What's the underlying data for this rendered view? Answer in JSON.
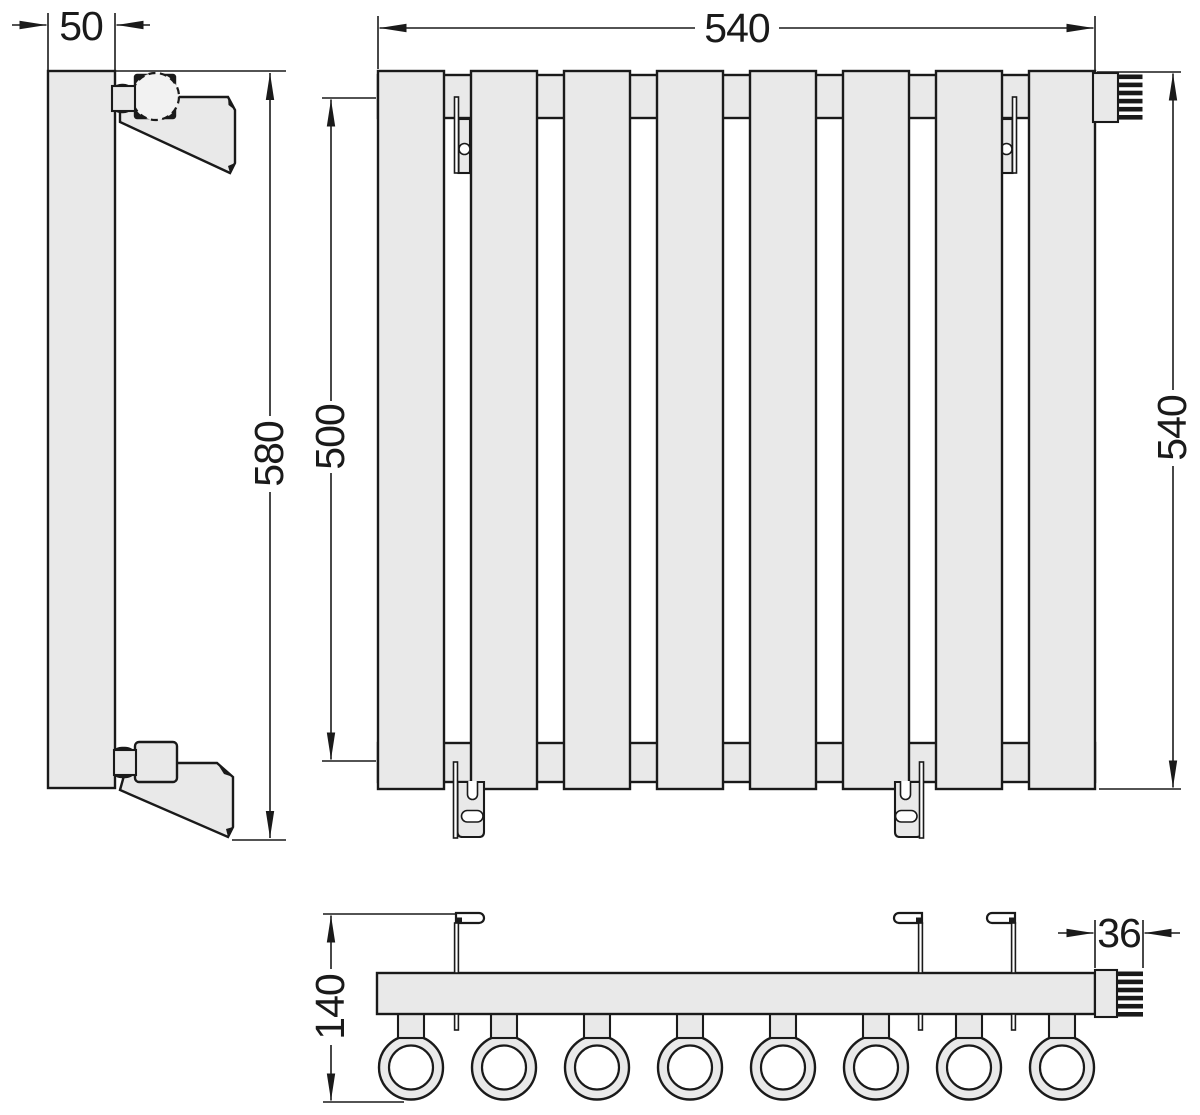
{
  "dims": {
    "side_panel_width": "50",
    "overall_height": "580",
    "mounting_distance": "500",
    "overall_width": "540",
    "panel_height": "540",
    "depth": "140",
    "connector_width": "36"
  },
  "counts": {
    "front_panels": 8,
    "bottom_tubes": 8,
    "wall_brackets": 4
  },
  "colors": {
    "outline": "#1a1a1a",
    "body_fill": "#e9e9e9",
    "background": "#ffffff"
  }
}
